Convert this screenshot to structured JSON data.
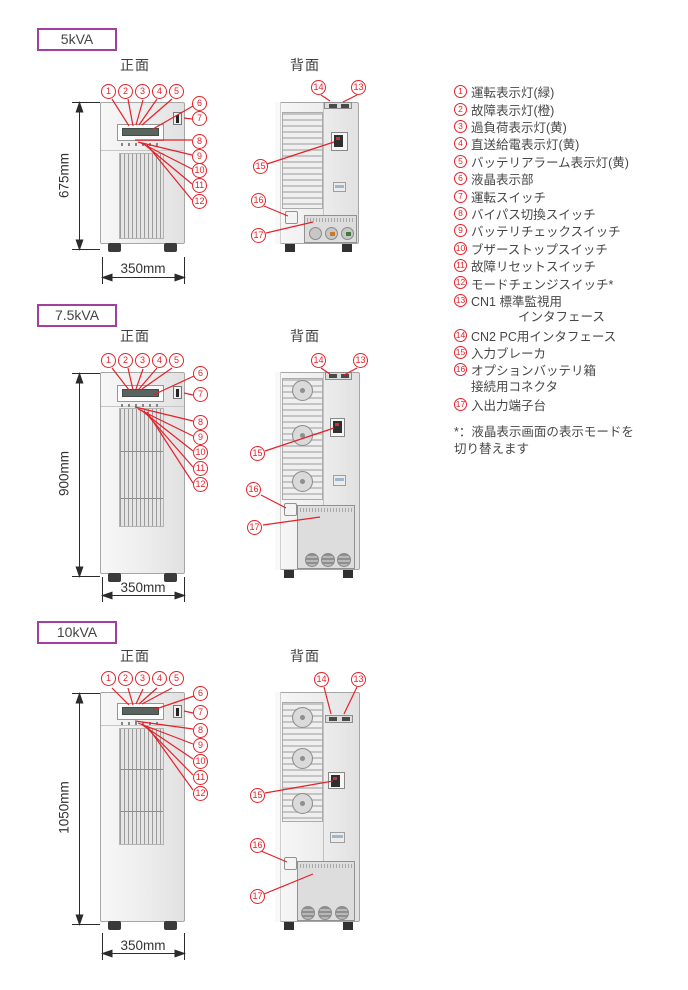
{
  "colors": {
    "callout_red": "#e62129",
    "model_box_border": "#a040a0",
    "text_dark": "#474747"
  },
  "sections": [
    {
      "model": "5kVA",
      "front_title": "正面",
      "back_title": "背面",
      "height_dim": "675mm",
      "width_dim": "350mm"
    },
    {
      "model": "7.5kVA",
      "front_title": "正面",
      "back_title": "背面",
      "height_dim": "900mm",
      "width_dim": "350mm"
    },
    {
      "model": "10kVA",
      "front_title": "正面",
      "back_title": "背面",
      "height_dim": "1050mm",
      "width_dim": "350mm"
    }
  ],
  "callouts": {
    "front": [
      "1",
      "2",
      "3",
      "4",
      "5",
      "6",
      "7",
      "8",
      "9",
      "10",
      "11",
      "12"
    ],
    "back": [
      "14",
      "13",
      "15",
      "16",
      "17"
    ]
  },
  "legend": {
    "items": [
      {
        "n": "1",
        "label": "運転表示灯(緑)"
      },
      {
        "n": "2",
        "label": "故障表示灯(橙)"
      },
      {
        "n": "3",
        "label": "過負荷表示灯(黄)"
      },
      {
        "n": "4",
        "label": "直送給電表示灯(黄)"
      },
      {
        "n": "5",
        "label": "バッテリアラーム表示灯(黄)"
      },
      {
        "n": "6",
        "label": "液晶表示部"
      },
      {
        "n": "7",
        "label": "運転スイッチ"
      },
      {
        "n": "8",
        "label": "バイパス切換スイッチ"
      },
      {
        "n": "9",
        "label": "バッテリチェックスイッチ"
      },
      {
        "n": "10",
        "label": "ブザーストップスイッチ"
      },
      {
        "n": "11",
        "label": "故障リセットスイッチ"
      },
      {
        "n": "12",
        "label": "モードチェンジスイッチ*"
      },
      {
        "n": "13",
        "label": "CN1 標準監視用",
        "label2": "インタフェース"
      },
      {
        "n": "14",
        "label": "CN2 PC用インタフェース"
      },
      {
        "n": "15",
        "label": "入力ブレーカ"
      },
      {
        "n": "16",
        "label": "オプションバッテリ箱",
        "label2": "接続用コネクタ"
      },
      {
        "n": "17",
        "label": "入出力端子台"
      }
    ],
    "footnote1": "*：液晶表示画面の表示モードを",
    "footnote2": "切り替えます"
  }
}
